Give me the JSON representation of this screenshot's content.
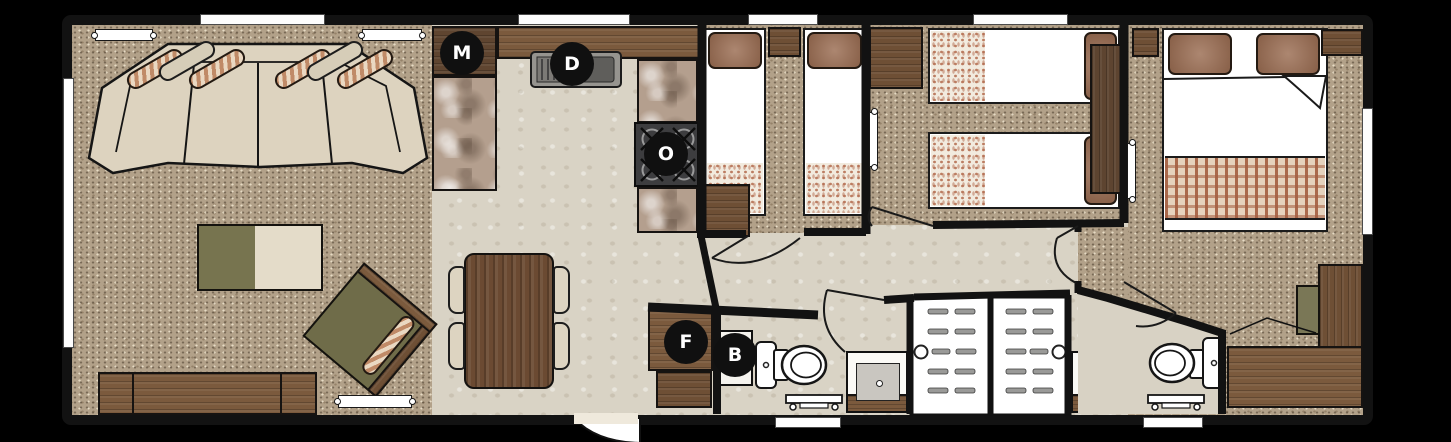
{
  "plan": {
    "description": "Static caravan holiday home floor plan, 3 bedrooms",
    "rooms": [
      "lounge",
      "kitchen-diner",
      "twin-bedroom-front",
      "twin-bedroom-middle",
      "master-bedroom",
      "shower-room",
      "en-suite"
    ]
  },
  "markers": {
    "microwave": "M",
    "dishwasher": "D",
    "oven": "O",
    "fridge": "F",
    "boiler": "B"
  },
  "palette": {
    "wall": "#121212",
    "carpet": "#b2a189",
    "hard_floor": "#d9d3c5",
    "wood": "#7b5a3d",
    "granite": "#b49f8e",
    "upholstery": "#ddd3bf",
    "cushion_brown": "#9a6c51",
    "olive": "#6f6c49",
    "appliance_dark": "#3d3d3f",
    "marker_bg": "#101010",
    "marker_text": "#ffffff"
  }
}
